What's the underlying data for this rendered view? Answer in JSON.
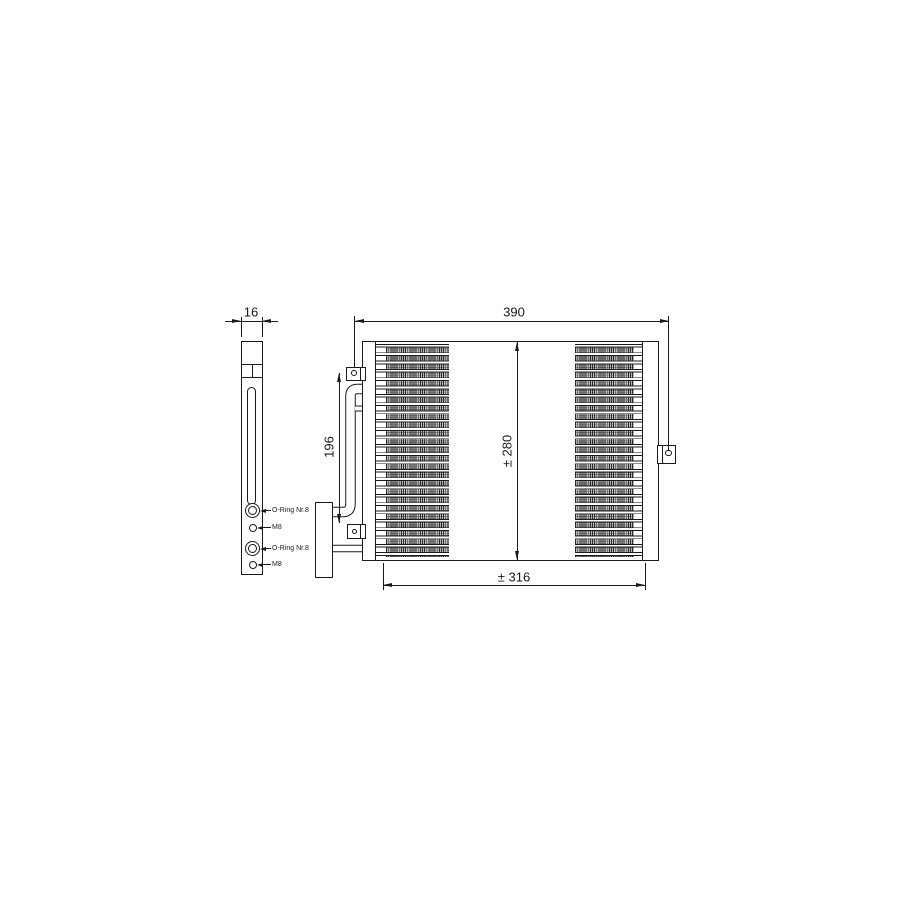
{
  "drawing": {
    "bg_color": "#ffffff",
    "line_color": "#1a1a1a"
  },
  "dimensions": {
    "side_thickness": "16",
    "overall_width": "390",
    "core_height": "± 280",
    "core_width": "± 316",
    "port_spacing": "196"
  },
  "side_view": {
    "port_labels": [
      "O-Ring Nr.8",
      "M8",
      "O-Ring Nr.8",
      "M8"
    ]
  }
}
